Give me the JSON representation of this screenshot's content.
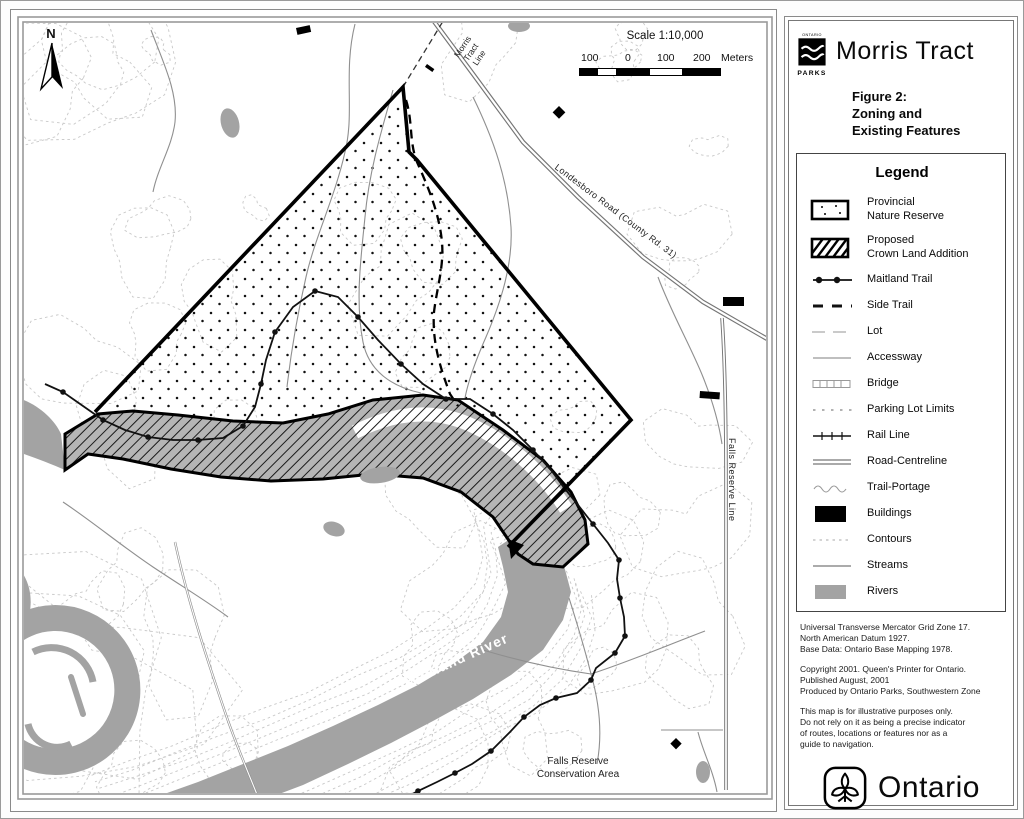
{
  "header": {
    "parks_logo_top": "ONTARIO",
    "parks_logo_bottom": "PARKS",
    "title": "Morris Tract",
    "figure_caption": "Figure 2:\nZoning and\nExisting Features"
  },
  "legend": {
    "title": "Legend",
    "items": [
      {
        "label": "Provincial\nNature Reserve",
        "type": "dotted-area"
      },
      {
        "label": "Proposed\nCrown Land Addition",
        "type": "hatched-area"
      },
      {
        "label": "Maitland Trail",
        "type": "line-with-dots"
      },
      {
        "label": "Side Trail",
        "type": "bold-dashed-line"
      },
      {
        "label": "Lot",
        "type": "long-dash-line"
      },
      {
        "label": "Accessway",
        "type": "thin-line"
      },
      {
        "label": "Bridge",
        "type": "ladder-symbol"
      },
      {
        "label": "Parking Lot Limits",
        "type": "dotted-line"
      },
      {
        "label": "Rail Line",
        "type": "ticked-line"
      },
      {
        "label": "Road-Centreline",
        "type": "double-line"
      },
      {
        "label": "Trail-Portage",
        "type": "wavy-line"
      },
      {
        "label": "Buildings",
        "type": "black-fill"
      },
      {
        "label": "Contours",
        "type": "faint-dotted-line"
      },
      {
        "label": "Streams",
        "type": "gray-line"
      },
      {
        "label": "Rivers",
        "type": "gray-fill"
      }
    ]
  },
  "map": {
    "north_label": "N",
    "scale": {
      "title": "Scale 1:10,000",
      "tick1": "100",
      "tick2": "0",
      "tick3": "100",
      "tick4": "200",
      "unit": "Meters"
    },
    "labels": {
      "morris_tract_line": "Morris\nTract\nLine",
      "londesboro_road": "Londesboro Road (County Rd. 31)",
      "falls_reserve_line": "Falls Reserve Line",
      "maitland_river": "Maitland River",
      "falls_reserve_area": "Falls Reserve\nConservation Area"
    }
  },
  "footer": {
    "datum": "Universal Transverse Mercator Grid Zone 17.\nNorth American Datum 1927.\nBase Data: Ontario Base Mapping 1978.",
    "copyright": "Copyright 2001. Queen's Printer for Ontario.\nPublished August, 2001\nProduced by Ontario Parks, Southwestern Zone",
    "disclaimer": "This map is for illustrative purposes only.\nDo not rely on it as being a precise indicator\nof routes, locations or features nor as a\nguide to navigation.",
    "ontario_wordmark": "Ontario"
  },
  "colors": {
    "river_gray": "#a3a3a3",
    "band_gray": "#b5b5b5",
    "contour_gray": "#c8c8c8",
    "stream_gray": "#8f8f8f",
    "road_gray": "#757575",
    "ink": "#0a0a0a"
  }
}
